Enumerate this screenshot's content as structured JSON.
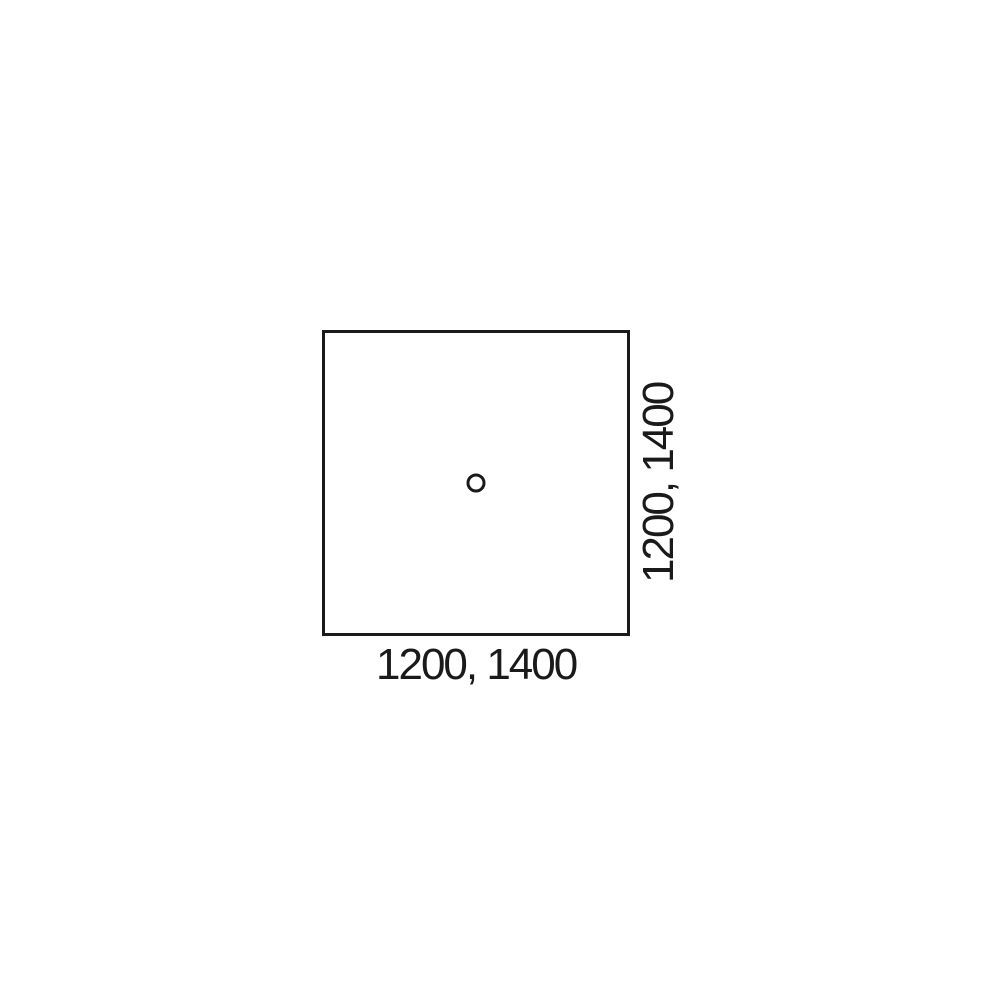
{
  "diagram": {
    "description": "Square panel top view with center hole",
    "bottom_label": "1200, 1400",
    "right_label": "1200, 1400",
    "line_color": "#1a1a1a",
    "background_color": "#ffffff"
  }
}
